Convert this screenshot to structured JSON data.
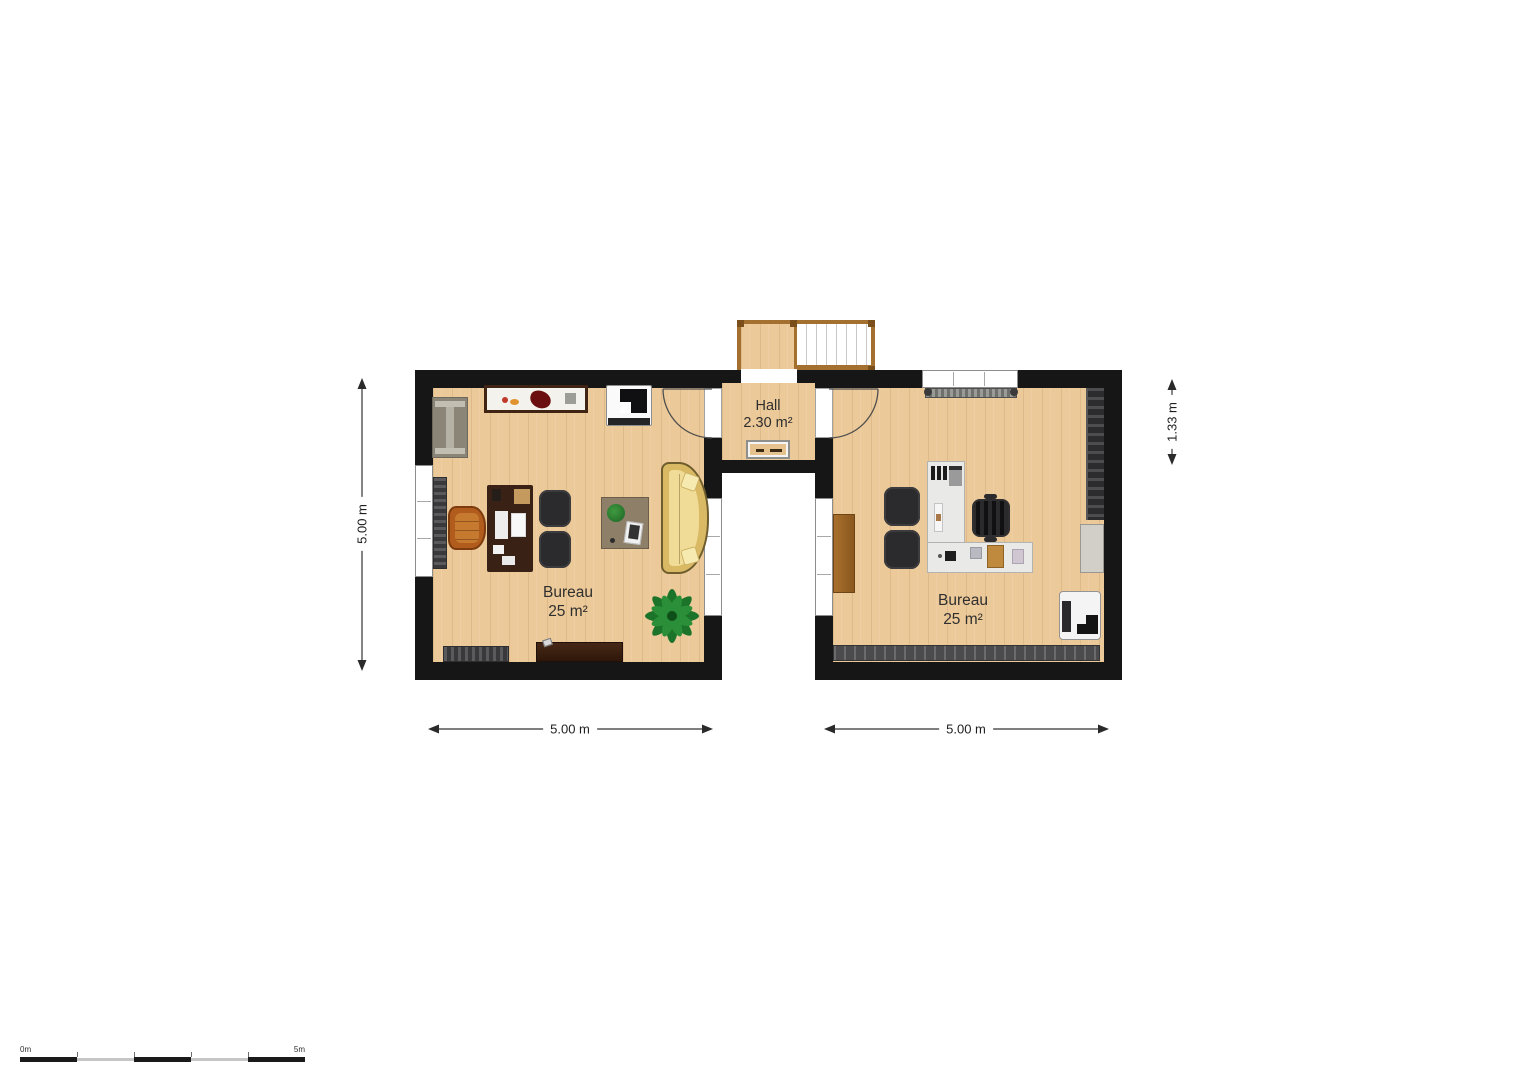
{
  "rooms": {
    "bureau_left": {
      "name": "Bureau",
      "area": "25 m²"
    },
    "bureau_right": {
      "name": "Bureau",
      "area": "25 m²"
    },
    "hall": {
      "name": "Hall",
      "area": "2.30 m²"
    }
  },
  "dimensions": {
    "left_height": "5.00 m",
    "right_height": "1.33 m",
    "bottom_left_width": "5.00 m",
    "bottom_right_width": "5.00 m"
  },
  "scale_bar": {
    "start_label": "0m",
    "end_label": "5m"
  },
  "colors": {
    "wall": "#161616",
    "floor_wood": "#ecc998",
    "sofa_yellow": "#d9b964",
    "executive_chair_orange": "#b15c1c",
    "desk_brown": "#3a2115",
    "plant_green": "#1c742a",
    "stair_frame_brown": "#a3702f"
  }
}
